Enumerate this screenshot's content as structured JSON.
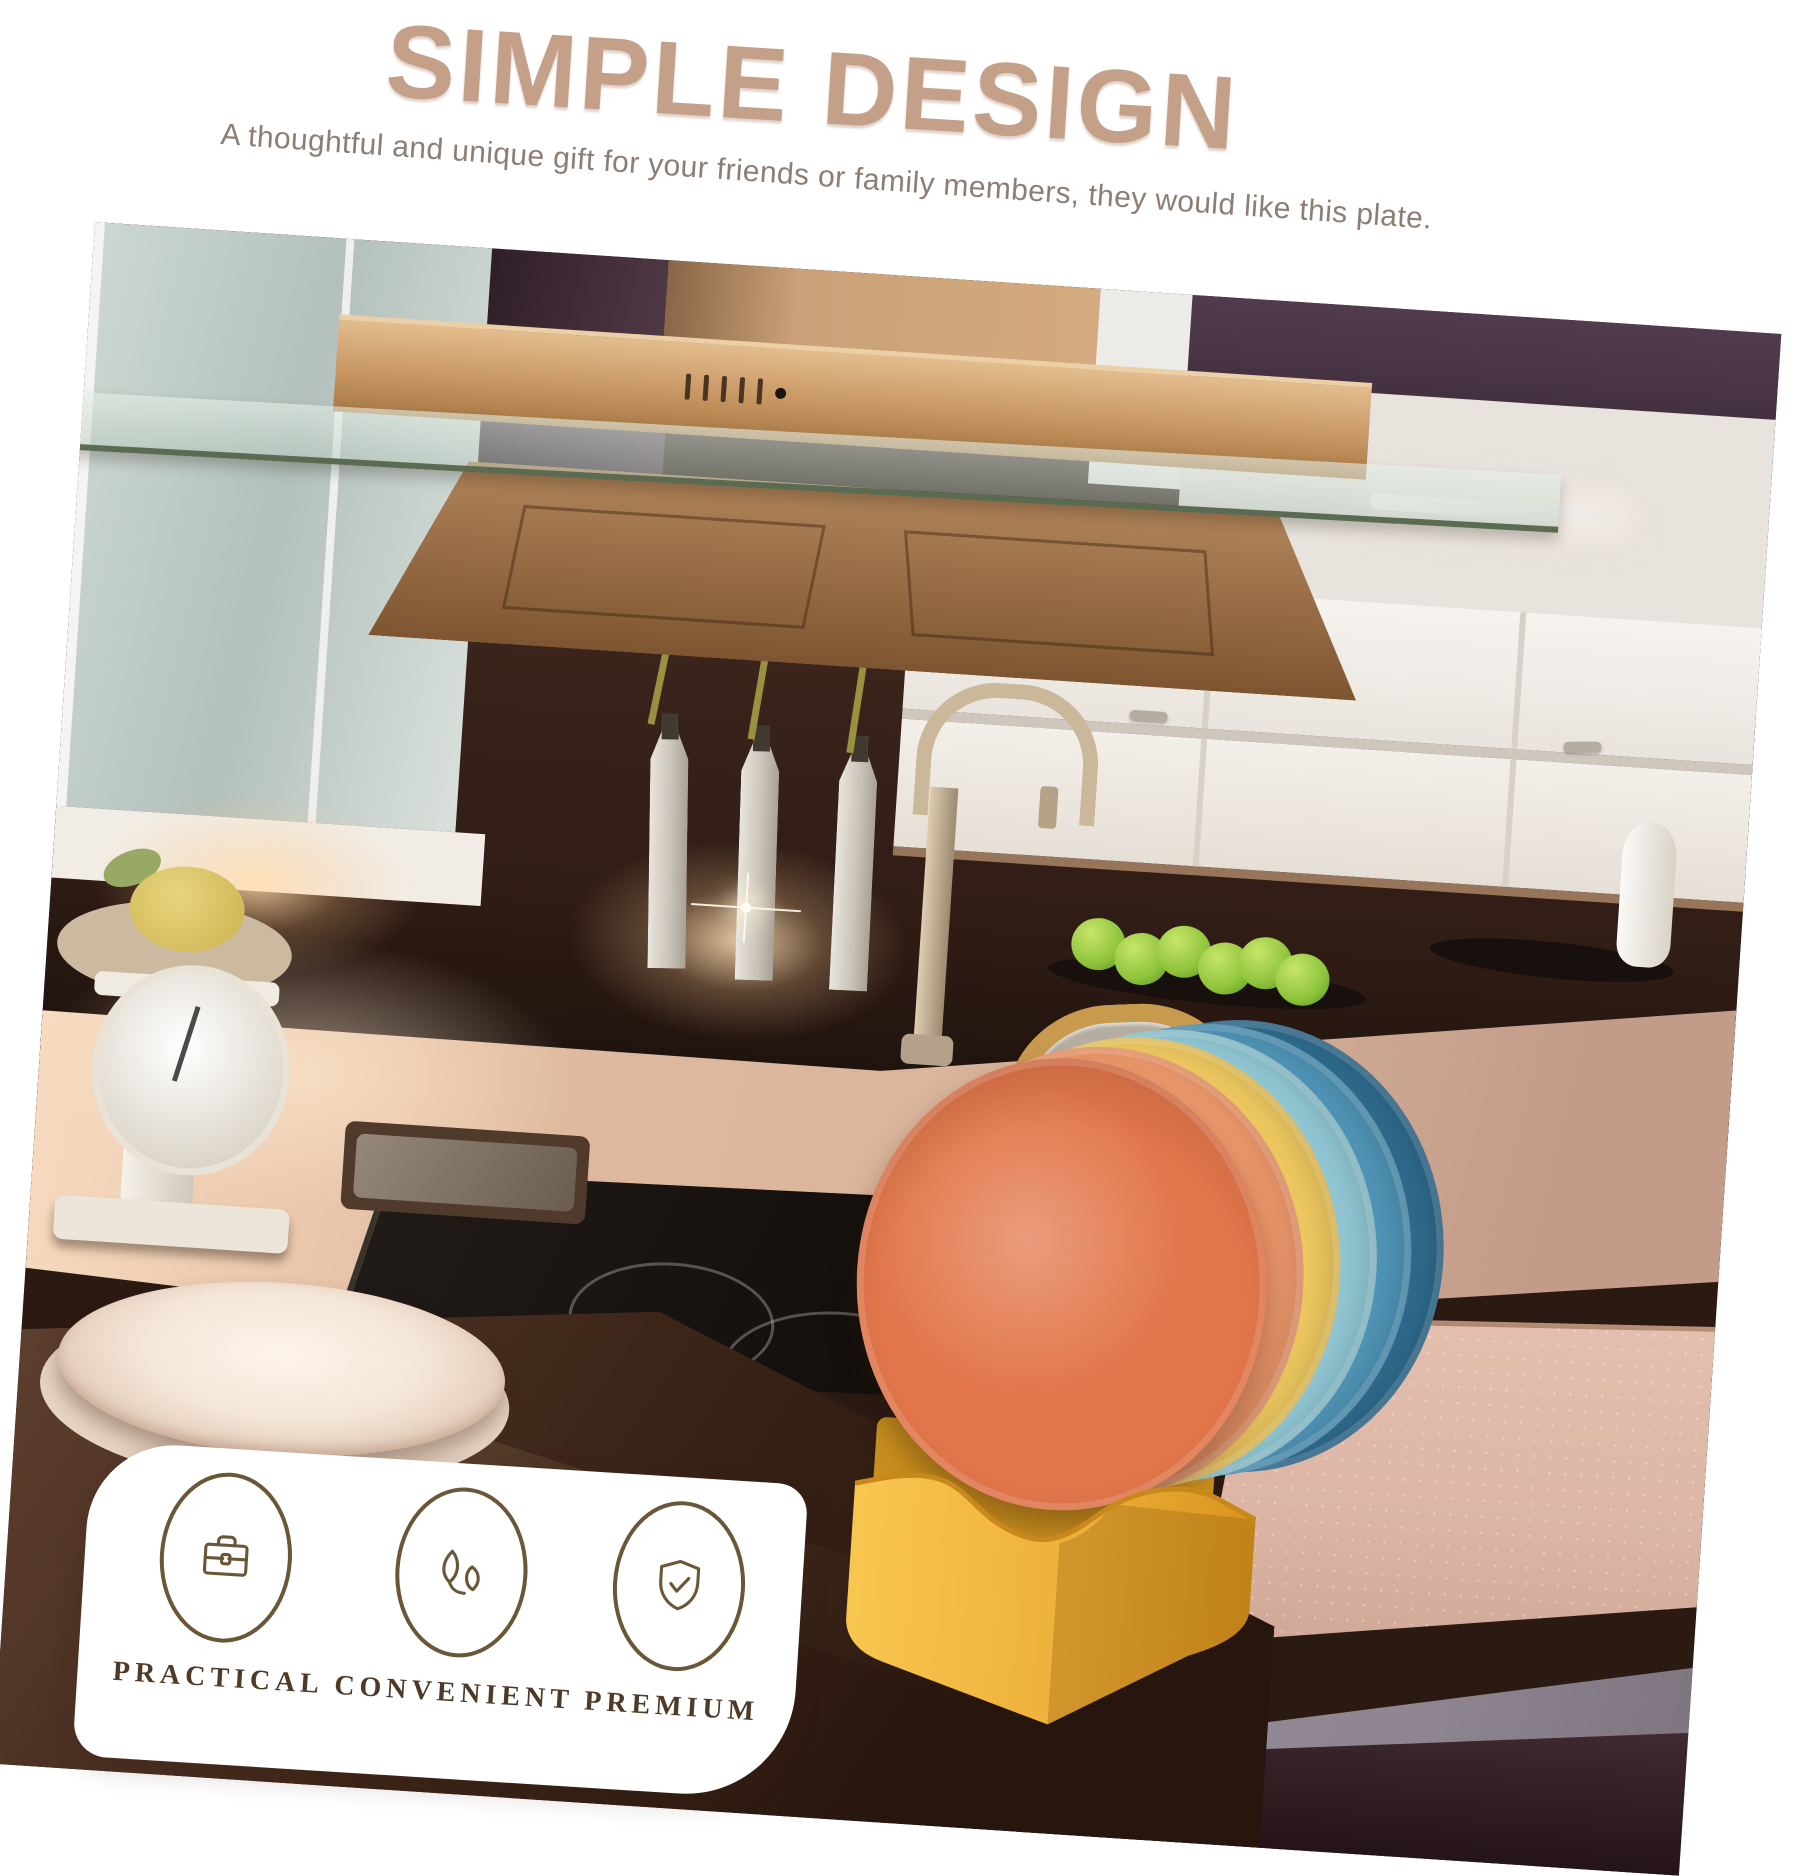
{
  "header": {
    "title": "SIMPLE DESIGN",
    "subtitle": "A thoughtful and unique gift for your friends or family members, they would like this plate.",
    "title_color": "#c5a089",
    "subtitle_color": "#8d7e75"
  },
  "badges": {
    "background": "#ffffff",
    "icon_color": "#6a5738",
    "label_color": "#4e3a26",
    "items": [
      {
        "icon": "briefcase-icon",
        "label": "PRACTICAL"
      },
      {
        "icon": "leaves-icon",
        "label": "CONVENIENT"
      },
      {
        "icon": "shield-check-icon",
        "label": "PREMIUM"
      }
    ]
  },
  "scene": {
    "objects": [
      "frosted-cabinets",
      "copper-range-hood",
      "white-flowers-in-bottle-vases",
      "vintage-kitchen-scale",
      "gooseneck-faucet",
      "sink",
      "green-apples-on-tray",
      "steel-kettle",
      "induction-cooktop",
      "white-plates",
      "colorful-plate-set",
      "yellow-plate-holder",
      "white-vase"
    ],
    "palette": {
      "wall_purple": "#513c4e",
      "wall_light": "#e8e3dd",
      "cabinet_frost": "#c6d1cb",
      "cabinet_white": "#f3f0ea",
      "hood_copper": "#c6965f",
      "backsplash_brown": "#301d15",
      "counter_pink": "#d9b49b",
      "cooktop_black": "#14100d",
      "kettle_gold": "#c89a4e",
      "apple_green": "#8fc43c",
      "holder_yellow": "#f2b83e",
      "floor_pink": "#dcb5a5",
      "floor_gray": "#8e8591",
      "plate_white": "#f4e6d7",
      "plate_colors": [
        "#e2764a",
        "#f09a6d",
        "#ecc75f",
        "#8fc6d2",
        "#4f93b5",
        "#2e6a8c"
      ]
    }
  }
}
